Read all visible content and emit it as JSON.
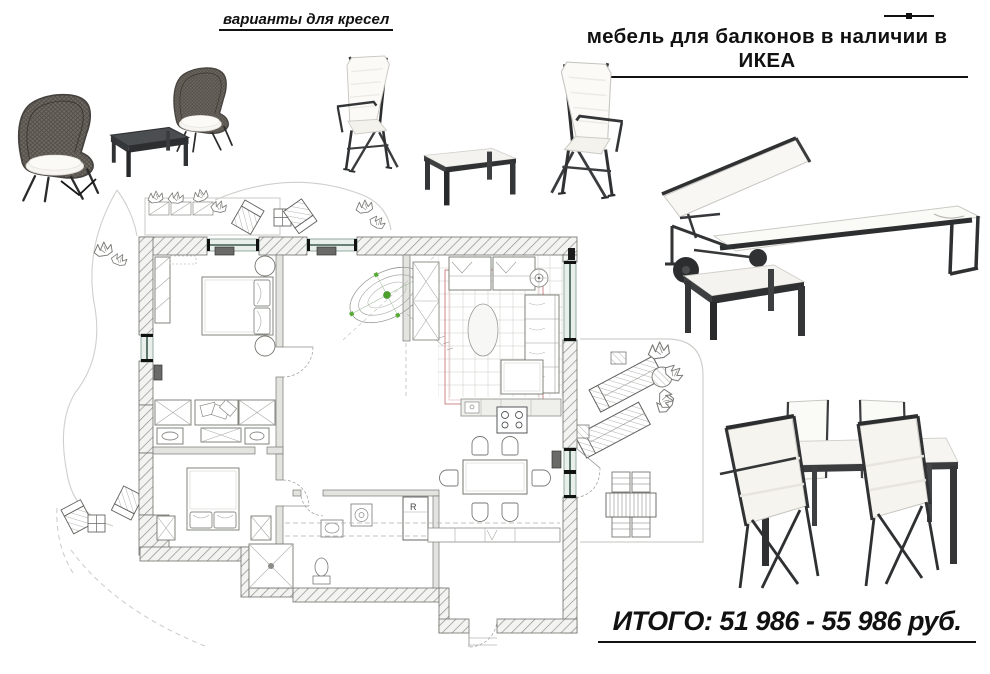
{
  "labels": {
    "chair_variants": "варианты для кресел",
    "title": "мебель для балконов в наличии в ИКЕА",
    "total": "ИТОГО: 51 986 - 55 986 руб."
  },
  "floor_plan": {
    "appliance_label": "R"
  },
  "illustrations": [
    {
      "name": "rattan-armchairs-set-photo"
    },
    {
      "name": "folding-chairs-set-photo"
    },
    {
      "name": "sun-lounger-with-table-photo"
    },
    {
      "name": "outdoor-dining-set-photo"
    },
    {
      "name": "apartment-floor-plan"
    }
  ],
  "colors": {
    "ink": "#111111",
    "accent_green": "#4ba02c",
    "carpet_red": "#c46a6a",
    "window_teal": "#3c5b51",
    "plan_gray": "#75776f"
  }
}
